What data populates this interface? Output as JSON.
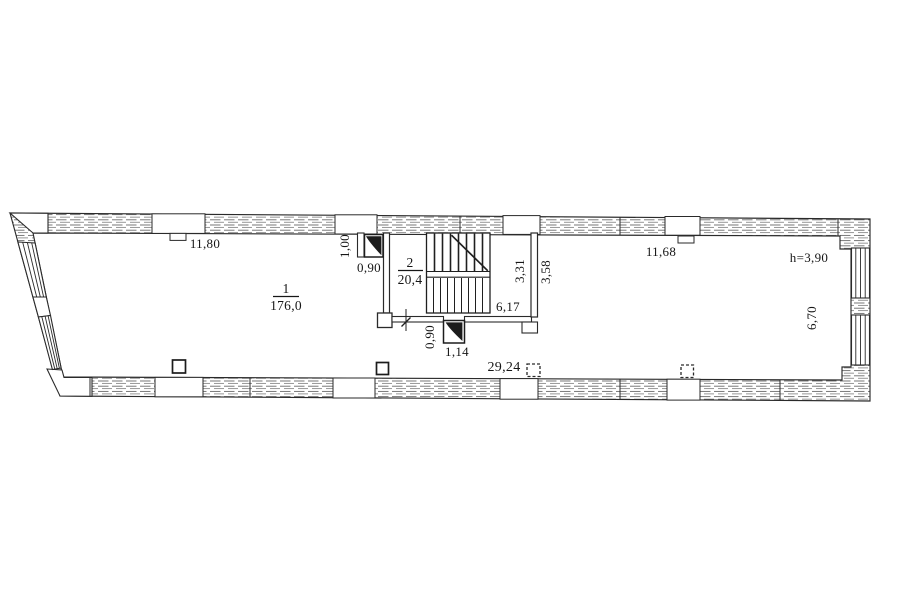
{
  "plan": {
    "rooms": [
      {
        "number": "1",
        "area": "176,0"
      },
      {
        "number": "2",
        "area": "20,4"
      }
    ],
    "dimensions": {
      "top_left_wall": "11,80",
      "top_right_wall": "11,68",
      "ceiling_height": "h=3,90",
      "stair_door_height": "1,00",
      "stair_door_clear": "0,90",
      "stair_inner_width": "3,31",
      "stair_outer_width": "3,58",
      "stair_length": "6,17",
      "bottom_door_clear": "0,90",
      "bottom_door_width": "1,14",
      "bottom_wall_length": "29,24",
      "right_room_depth": "6,70"
    },
    "colors": {
      "ink": "#1c1c1c",
      "paper": "#ffffff"
    }
  }
}
